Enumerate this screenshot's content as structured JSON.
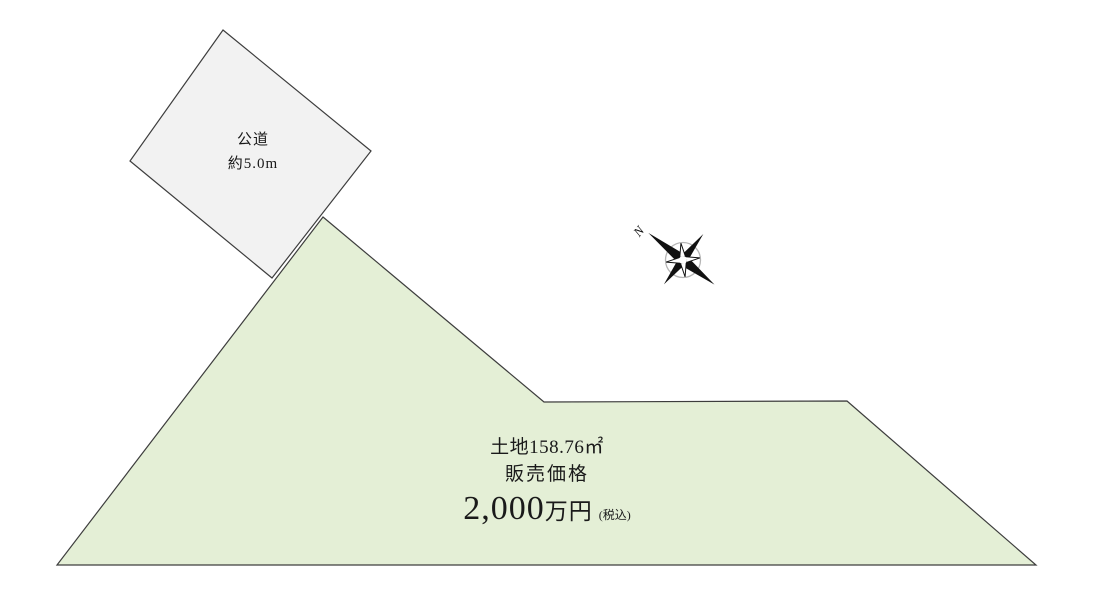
{
  "diagram": {
    "background_color": "#ffffff",
    "outline_color": "#3d3d3d"
  },
  "road": {
    "name": "公道",
    "width": "約5.0m",
    "fill_color": "#f2f2f2"
  },
  "land": {
    "area": "土地158.76㎡",
    "price_caption": "販売価格",
    "price_amount": "2,000",
    "price_unit": "万円",
    "price_tax_note": "(税込)",
    "fill_color": "#e4efd6"
  },
  "compass": {
    "north_label": "N"
  }
}
